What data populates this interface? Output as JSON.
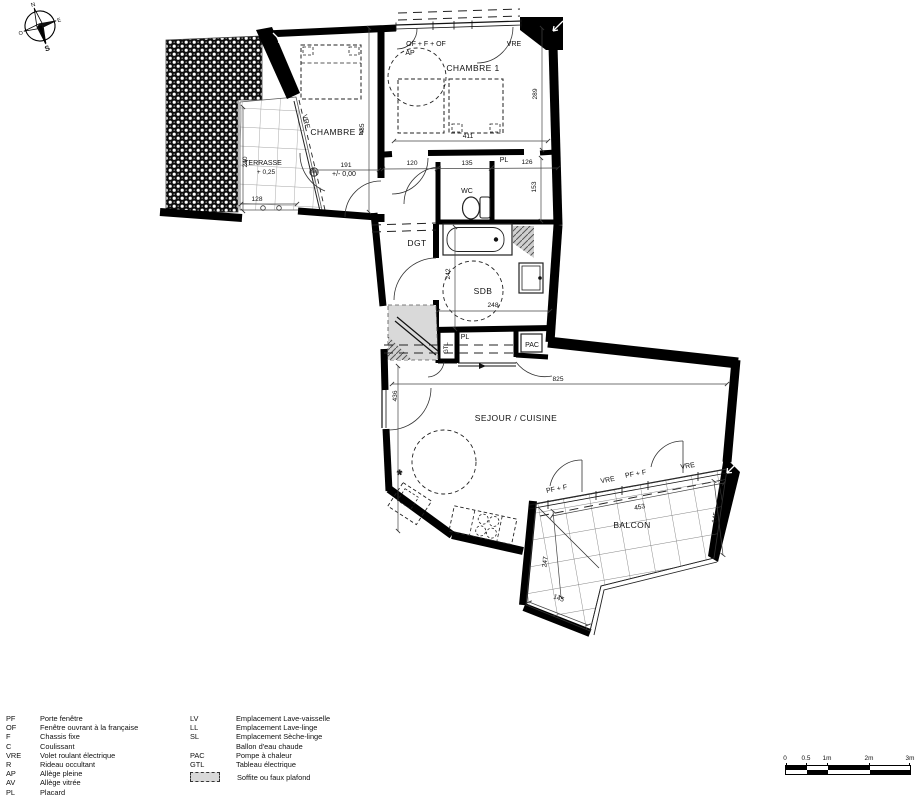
{
  "compass": {
    "north": "N",
    "east": "E",
    "south": "S",
    "west": "O"
  },
  "rooms": {
    "terrasse": "TERRASSE",
    "terrasse_level": "+ 0,25",
    "chambre2": "CHAMBRE 2",
    "chambre1": "CHAMBRE 1",
    "wc": "WC",
    "dgt": "DGT",
    "sdb": "SDB",
    "pac": "PAC",
    "gtl": "GTL",
    "pl_top": "PL",
    "pl_mid": "PL",
    "sejour": "SEJOUR / CUISINE",
    "sejour_level": "+/- 0,00",
    "balcon": "BALCON"
  },
  "openings": {
    "of_f_of": "OF + F + OF",
    "ap": "AP",
    "vre_top": "VRE",
    "vre_terrasse": "VRE",
    "pf_f_left": "PF + F",
    "vre_balcon_left": "VRE",
    "pf_f_right": "PF + F",
    "vre_balcon_right": "VRE"
  },
  "dims": {
    "terrasse_depth": "240",
    "terrasse_width": "128",
    "chambre2_height": "435",
    "hall_chambre2": "191",
    "chambre1_height": "289",
    "chambre1_width": "411",
    "hall_width": "120",
    "wc_width": "135",
    "pl_width": "126",
    "pl_depth": "153",
    "sdb_height": "242",
    "sdb_width": "248",
    "sejour_width": "825",
    "sejour_height": "436",
    "balcon_width": "453",
    "balcon_depth_right": "145",
    "balcon_depth_left": "247",
    "balcon_width_bottom": "145"
  },
  "legend": {
    "col1": [
      {
        "abbr": "PF",
        "label": "Porte fenêtre"
      },
      {
        "abbr": "OF",
        "label": "Fenêtre ouvrant à la française"
      },
      {
        "abbr": "F",
        "label": "Chassis fixe"
      },
      {
        "abbr": "C",
        "label": "Coulissant"
      },
      {
        "abbr": "VRE",
        "label": "Volet roulant électrique"
      },
      {
        "abbr": "R",
        "label": "Rideau occultant"
      },
      {
        "abbr": "AP",
        "label": "Allège pleine"
      },
      {
        "abbr": "AV",
        "label": "Allège vitrée"
      },
      {
        "abbr": "PL",
        "label": "Placard"
      }
    ],
    "col2": [
      {
        "abbr": "LV",
        "label": "Emplacement Lave-vaisselle"
      },
      {
        "abbr": "LL",
        "label": "Emplacement Lave-linge"
      },
      {
        "abbr": "SL",
        "label": "Emplacement Sèche-linge"
      },
      {
        "abbr": "BEC",
        "label": "Ballon d'eau chaude"
      },
      {
        "abbr": "PAC",
        "label": "Pompe à chaleur"
      },
      {
        "abbr": "GTL",
        "label": "Tableau électrique"
      }
    ],
    "soffite": "Soffite ou faux plafond"
  },
  "scalebar": {
    "t0": "0",
    "t05": "0.5",
    "t1": "1m",
    "t2": "2m",
    "t3": "3m"
  }
}
